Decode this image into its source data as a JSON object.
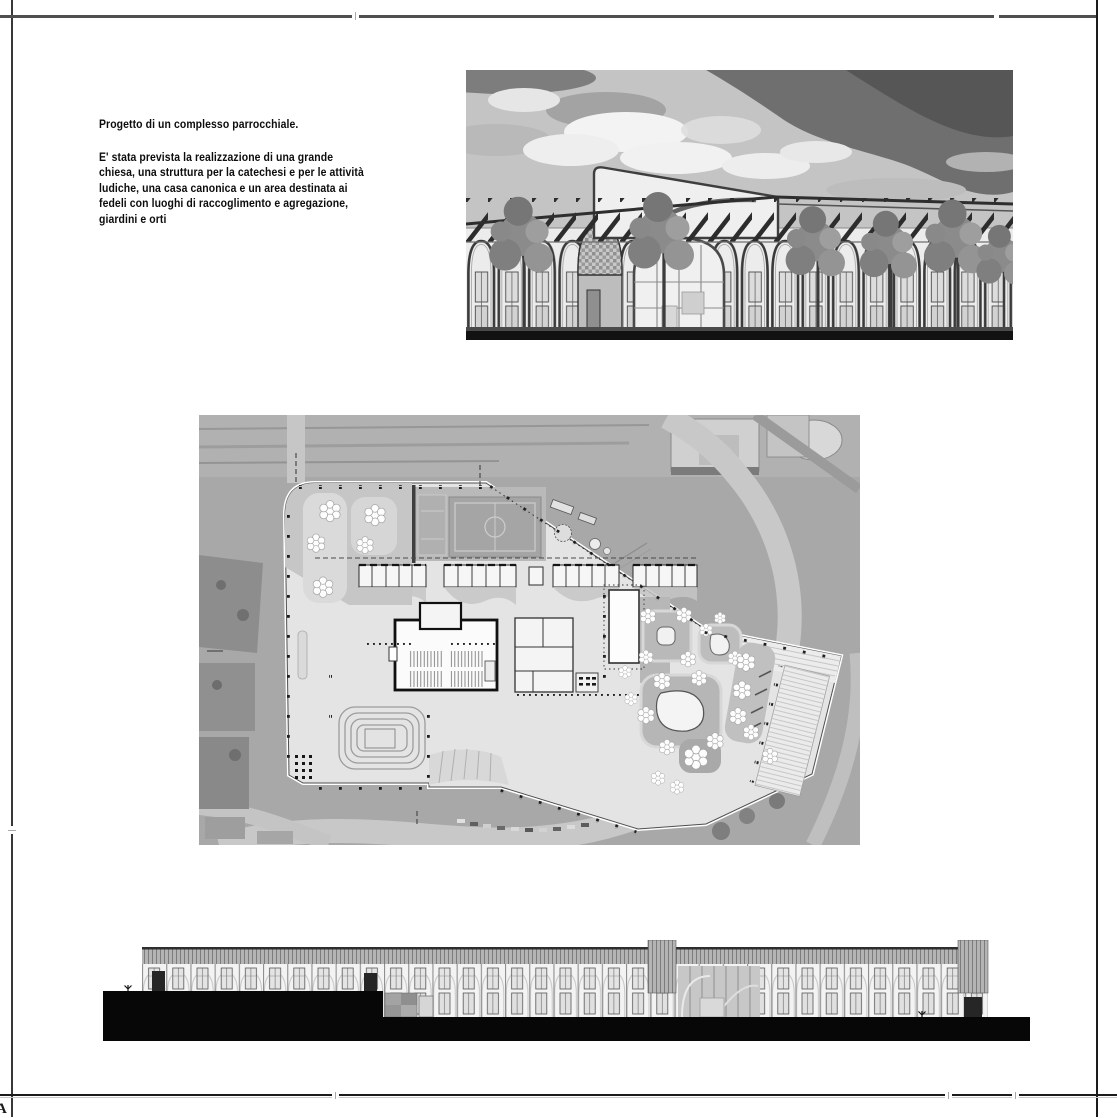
{
  "sheet": {
    "corner_mark": "A"
  },
  "intro": {
    "title": "Progetto di un complesso parrocchiale.",
    "body": "E' stata prevista la realizzazione di una grande\nchiesa, una struttura per la catechesi e per le attività\nludiche, una casa canonica e un area destinata ai\nfedeli con luoghi di raccoglimento e agregazione,\ngiardini e orti"
  },
  "figures": {
    "rendering": {
      "kind": "perspective-rendering",
      "subject": "arched parish building with pergola roof, glazed bays and trees under a dramatic cloudy sky"
    },
    "site_plan": {
      "kind": "aerial-site-plan",
      "subject": "parish complex plan over aerial photo: church with pews, catechesis rooms, sports field, gardens, playgrounds, amphitheatre and terraces"
    },
    "elevation": {
      "kind": "building-elevation",
      "subject": "long two-storey arched facade with striped roof band above a solid black ground mass"
    }
  },
  "palette": {
    "paper": "#ffffff",
    "ink": "#111111",
    "frame_line": "#3f3f3f",
    "aerial_gray": "#a8a8a8",
    "plan_plate": "#e4e4e4",
    "black_mass": "#070707"
  }
}
